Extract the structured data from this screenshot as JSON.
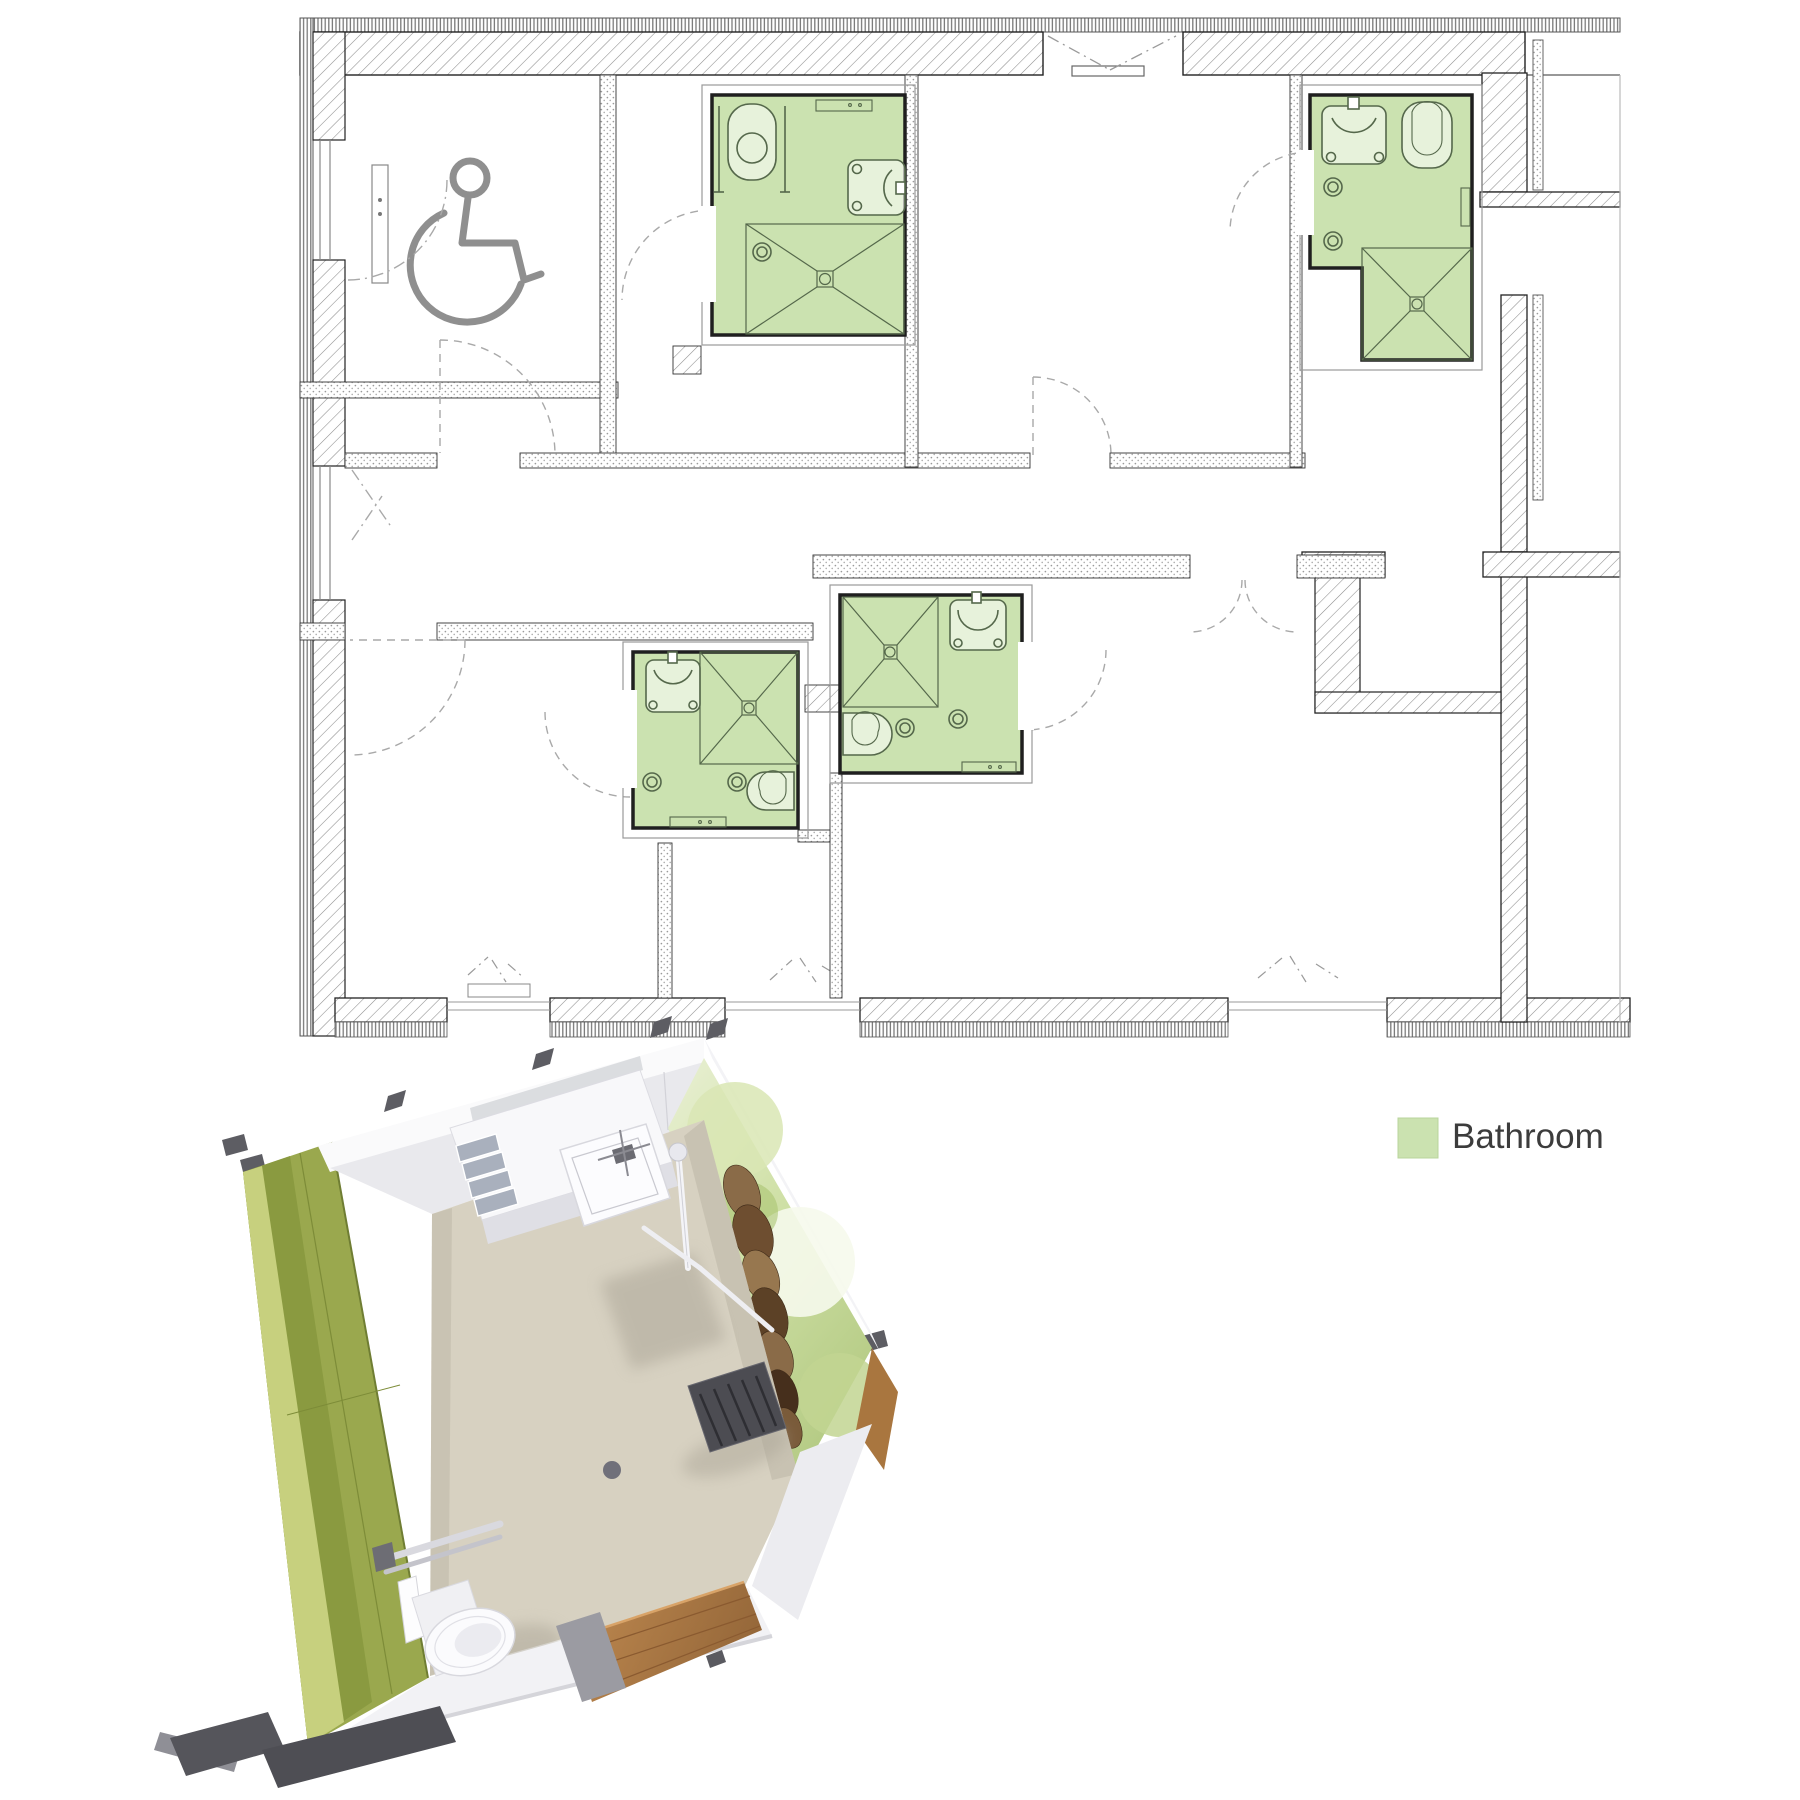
{
  "legend": {
    "label": "Bathroom",
    "swatch_color": "#cbe2b0",
    "label_color": "#3c3c3c"
  },
  "floor_plan": {
    "highlight_color": "#cbe2b0",
    "wall_color": "#1f1f1f",
    "hatch_color": "#8d8d8d",
    "fixture_line_color": "#55684b",
    "door_swing_color": "#a9a9a9",
    "bathrooms": [
      {
        "id": "bathroom-1",
        "fixtures": [
          "toilet",
          "washbasin",
          "shower",
          "floor-drain"
        ]
      },
      {
        "id": "bathroom-2",
        "fixtures": [
          "washbasin",
          "toilet",
          "shower",
          "floor-drain"
        ]
      },
      {
        "id": "bathroom-3",
        "fixtures": [
          "washbasin",
          "shower",
          "toilet",
          "floor-drain"
        ]
      },
      {
        "id": "bathroom-4",
        "fixtures": [
          "shower",
          "washbasin",
          "toilet",
          "floor-drain"
        ]
      }
    ],
    "symbols": [
      "wheelchair-accessible"
    ]
  },
  "render_3d": {
    "subject": "bathroom-module-axonometric",
    "colors": {
      "wall_green": "#93a24a",
      "wall_green_light": "#c7d07e",
      "wall_white": "#ededf0",
      "floor": "#d7d1c1",
      "mural_green": "#b6cc86",
      "wood": "#b27c46",
      "bracket": "#55555b"
    }
  }
}
